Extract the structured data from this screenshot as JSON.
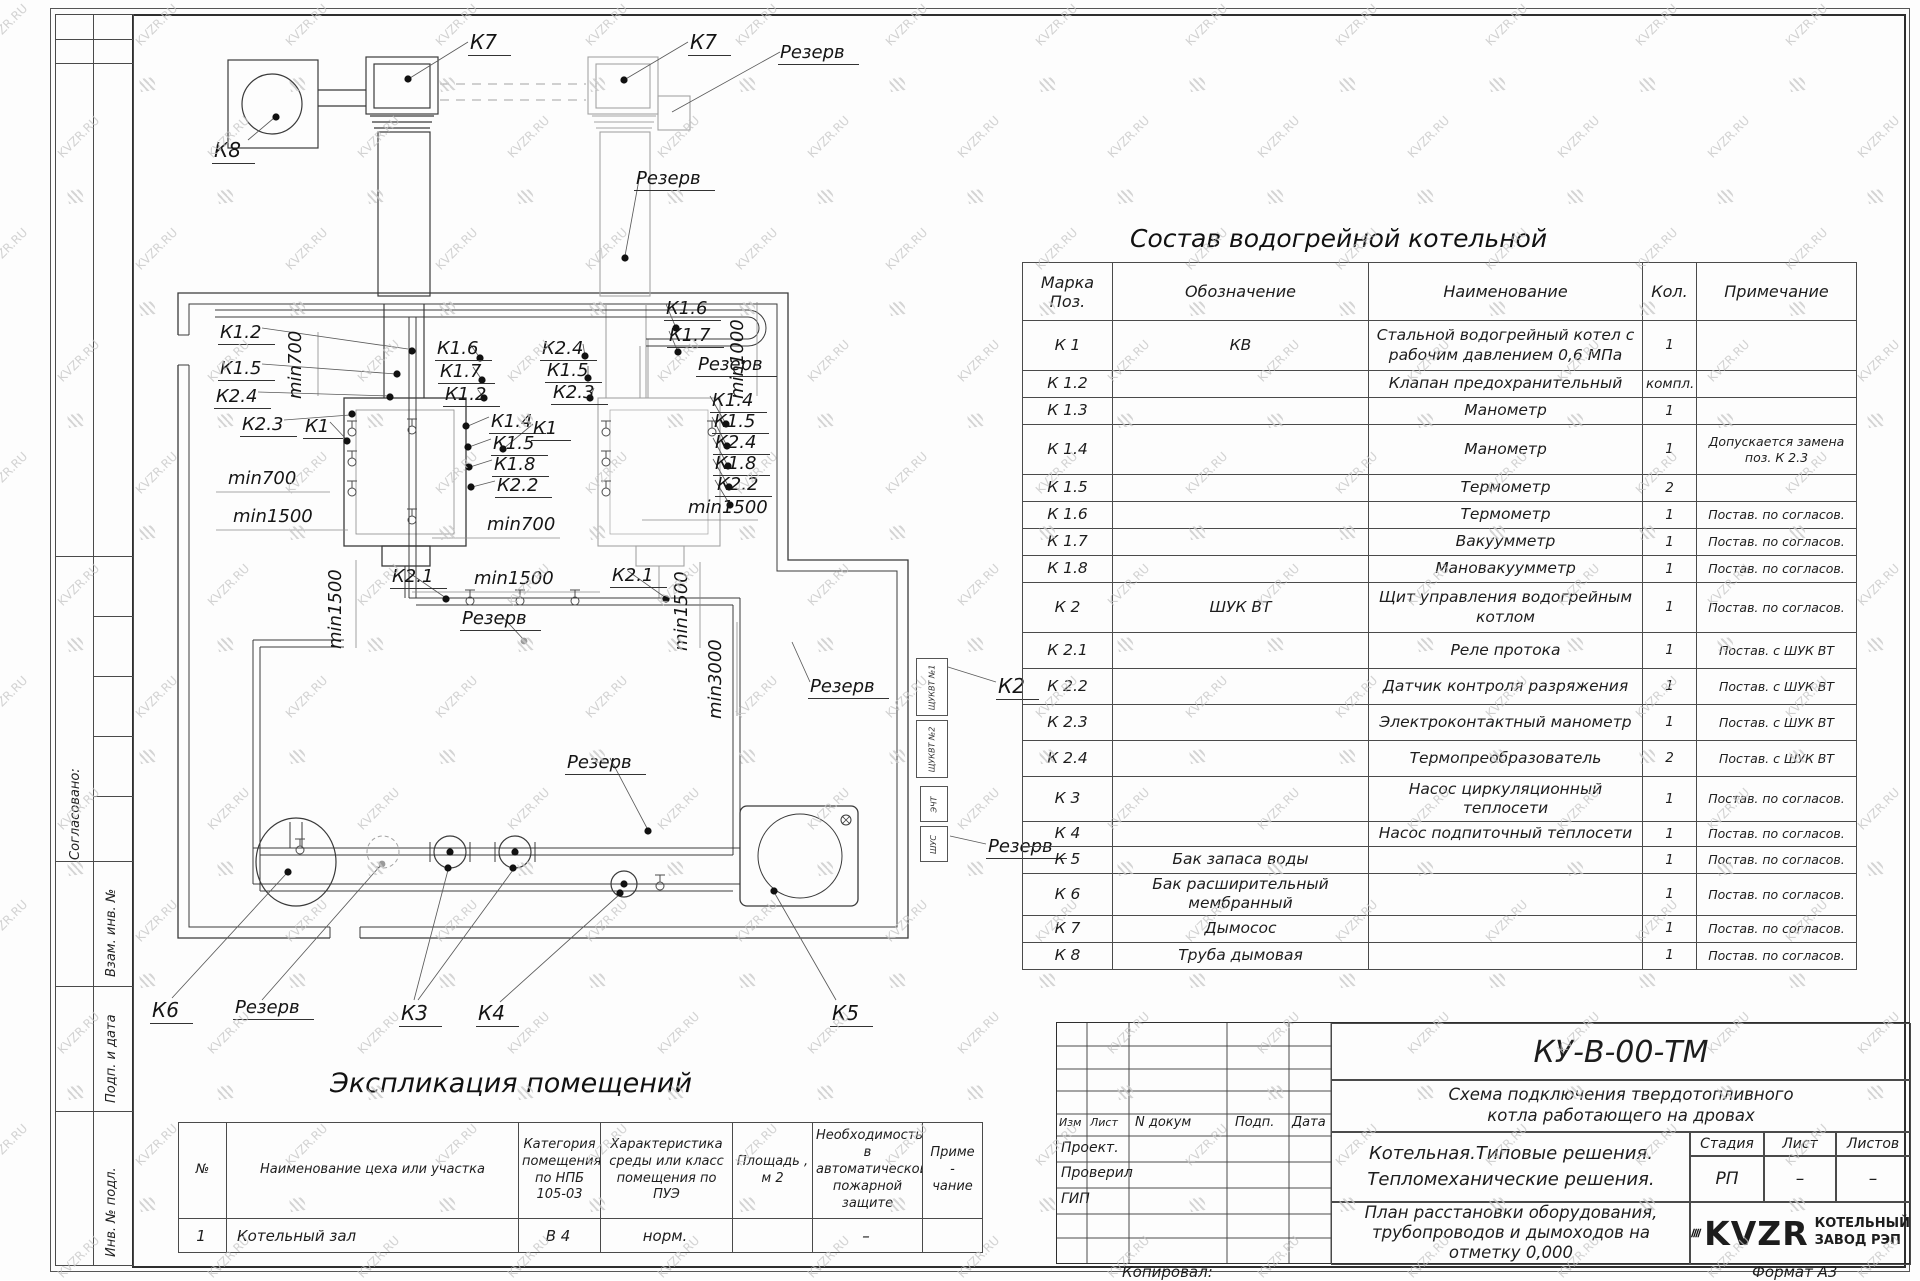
{
  "watermark": {
    "text": "KVZR.RU"
  },
  "frame": {
    "left_stamps": [
      "Согласовано:",
      "Взам. инв. №",
      "Подп. и дата",
      "Инв. № подл."
    ],
    "copied_label": "Копировал:",
    "format_label": "Формат А3"
  },
  "plan": {
    "labels": [
      {
        "t": "К7",
        "x": 468,
        "y": 30,
        "u": 1,
        "big": 1
      },
      {
        "t": "К7",
        "x": 688,
        "y": 30,
        "u": 1,
        "big": 1
      },
      {
        "t": "К8",
        "x": 212,
        "y": 138,
        "u": 1,
        "big": 1
      },
      {
        "t": "Резерв",
        "x": 778,
        "y": 42,
        "u": 1
      },
      {
        "t": "Резерв",
        "x": 634,
        "y": 168,
        "u": 1
      },
      {
        "t": "К1.2",
        "x": 218,
        "y": 322,
        "u": 1
      },
      {
        "t": "К1.5",
        "x": 218,
        "y": 358,
        "u": 1
      },
      {
        "t": "К2.4",
        "x": 214,
        "y": 386,
        "u": 1
      },
      {
        "t": "К2.3",
        "x": 240,
        "y": 414,
        "u": 1
      },
      {
        "t": "К1",
        "x": 303,
        "y": 416,
        "u": 1
      },
      {
        "t": "min700",
        "x": 306,
        "y": 398,
        "v": 1
      },
      {
        "t": "min700",
        "x": 228,
        "y": 468
      },
      {
        "t": "min1500",
        "x": 233,
        "y": 506
      },
      {
        "t": "min1500",
        "x": 346,
        "y": 648,
        "v": 1
      },
      {
        "t": "К1.6",
        "x": 435,
        "y": 338,
        "u": 1
      },
      {
        "t": "К1.7",
        "x": 438,
        "y": 361,
        "u": 1
      },
      {
        "t": "К1.2",
        "x": 443,
        "y": 384,
        "u": 1
      },
      {
        "t": "К2.4",
        "x": 540,
        "y": 338,
        "u": 1
      },
      {
        "t": "К1.5",
        "x": 545,
        "y": 360,
        "u": 1
      },
      {
        "t": "К2.3",
        "x": 551,
        "y": 382,
        "u": 1
      },
      {
        "t": "К1.4",
        "x": 489,
        "y": 411,
        "u": 1
      },
      {
        "t": "К1.5",
        "x": 491,
        "y": 433,
        "u": 1
      },
      {
        "t": "К1.8",
        "x": 492,
        "y": 454,
        "u": 1
      },
      {
        "t": "К2.2",
        "x": 495,
        "y": 475,
        "u": 1
      },
      {
        "t": "К1",
        "x": 531,
        "y": 418,
        "u": 1
      },
      {
        "t": "min700",
        "x": 487,
        "y": 514
      },
      {
        "t": "min1500",
        "x": 474,
        "y": 568
      },
      {
        "t": "К2.1",
        "x": 390,
        "y": 566,
        "u": 1
      },
      {
        "t": "К1.6",
        "x": 664,
        "y": 298,
        "u": 1
      },
      {
        "t": "К1.7",
        "x": 667,
        "y": 325,
        "u": 1
      },
      {
        "t": "Резерв",
        "x": 696,
        "y": 354,
        "u": 1
      },
      {
        "t": "min1000",
        "x": 748,
        "y": 398,
        "v": 1
      },
      {
        "t": "К1.4",
        "x": 710,
        "y": 390,
        "u": 1
      },
      {
        "t": "К1.5",
        "x": 712,
        "y": 411,
        "u": 1
      },
      {
        "t": "К2.4",
        "x": 713,
        "y": 432,
        "u": 1
      },
      {
        "t": "К1.8",
        "x": 713,
        "y": 453,
        "u": 1
      },
      {
        "t": "К2.2",
        "x": 715,
        "y": 474,
        "u": 1
      },
      {
        "t": "min1500",
        "x": 688,
        "y": 497
      },
      {
        "t": "min1500",
        "x": 692,
        "y": 650,
        "v": 1
      },
      {
        "t": "К2.1",
        "x": 610,
        "y": 565,
        "u": 1
      },
      {
        "t": "min3000",
        "x": 726,
        "y": 718,
        "v": 1
      },
      {
        "t": "Резерв",
        "x": 808,
        "y": 676,
        "u": 1
      },
      {
        "t": "К2",
        "x": 996,
        "y": 674,
        "u": 1,
        "big": 1
      },
      {
        "t": "Резерв",
        "x": 986,
        "y": 836,
        "u": 1
      },
      {
        "t": "Резерв",
        "x": 460,
        "y": 608,
        "u": 1
      },
      {
        "t": "Резерв",
        "x": 565,
        "y": 752,
        "u": 1
      },
      {
        "t": "К6",
        "x": 150,
        "y": 998,
        "u": 1,
        "big": 1
      },
      {
        "t": "Резерв",
        "x": 233,
        "y": 997,
        "u": 1
      },
      {
        "t": "К3",
        "x": 399,
        "y": 1001,
        "u": 1,
        "big": 1
      },
      {
        "t": "К4",
        "x": 476,
        "y": 1001,
        "u": 1,
        "big": 1
      },
      {
        "t": "К5",
        "x": 830,
        "y": 1001,
        "u": 1,
        "big": 1
      }
    ],
    "boxes": [
      {
        "t": "ЩУКВТ №1",
        "x": 916,
        "y": 658,
        "w": 30,
        "h": 56
      },
      {
        "t": "ЩУКВТ №2",
        "x": 916,
        "y": 720,
        "w": 30,
        "h": 56
      },
      {
        "t": "ЭЧТ",
        "x": 920,
        "y": 786,
        "w": 26,
        "h": 34
      },
      {
        "t": "ШУС",
        "x": 920,
        "y": 826,
        "w": 26,
        "h": 34
      }
    ]
  },
  "parts_table": {
    "title": "Состав водогрейной котельной",
    "header": {
      "pos": "Марка\nПоз.",
      "des": "Обозначение",
      "name": "Наименование",
      "qty": "Кол.",
      "note": "Примечание"
    },
    "rows": [
      {
        "pos": "К 1",
        "des": "КВ",
        "name": "Стальной водогрейный котел с рабочим давлением 0,6  МПа",
        "qty": "1",
        "note": "",
        "h": 50
      },
      {
        "pos": "К 1.2",
        "des": "",
        "name": "Клапан предохранительный",
        "qty": "компл.",
        "note": "",
        "h": 27
      },
      {
        "pos": "К 1.3",
        "des": "",
        "name": "Манометр",
        "qty": "1",
        "note": "",
        "h": 27
      },
      {
        "pos": "К 1.4",
        "des": "",
        "name": "Манометр",
        "qty": "1",
        "note": "Допускается замена поз. К 2.3",
        "h": 50
      },
      {
        "pos": "К 1.5",
        "des": "",
        "name": "Термометр",
        "qty": "2",
        "note": "",
        "h": 27
      },
      {
        "pos": "К 1.6",
        "des": "",
        "name": "Термометр",
        "qty": "1",
        "note": "Постав. по согласов.",
        "h": 27
      },
      {
        "pos": "К 1.7",
        "des": "",
        "name": "Вакуумметр",
        "qty": "1",
        "note": "Постав. по согласов.",
        "h": 27
      },
      {
        "pos": "К 1.8",
        "des": "",
        "name": "Мановакуумметр",
        "qty": "1",
        "note": "Постав. по согласов.",
        "h": 27
      },
      {
        "pos": "К 2",
        "des": "ШУК ВТ",
        "name": "Щит управления водогрейным котлом",
        "qty": "1",
        "note": "Постав. по согласов.",
        "h": 50
      },
      {
        "pos": "К 2.1",
        "des": "",
        "name": "Реле протока",
        "qty": "1",
        "note": "Постав. с ШУК ВТ",
        "h": 36
      },
      {
        "pos": "К 2.2",
        "des": "",
        "name": "Датчик контроля разряжения",
        "qty": "1",
        "note": "Постав. с ШУК ВТ",
        "h": 36
      },
      {
        "pos": "К 2.3",
        "des": "",
        "name": "Электроконтактный манометр",
        "qty": "1",
        "note": "Постав. с ШУК ВТ",
        "h": 36
      },
      {
        "pos": "К 2.4",
        "des": "",
        "name": "Термопреобразователь",
        "qty": "2",
        "note": "Постав. с ШУК ВТ",
        "h": 36
      },
      {
        "pos": "К 3",
        "des": "",
        "name": "Насос циркуляционный теплосети",
        "qty": "1",
        "note": "Постав. по согласов.",
        "h": 45
      },
      {
        "pos": "К 4",
        "des": "",
        "name": "Насос подпиточный теплосети",
        "qty": "1",
        "note": "Постав. по согласов.",
        "h": 25
      },
      {
        "pos": "К 5",
        "des": "Бак запаса воды",
        "name": "",
        "qty": "1",
        "note": "Постав. по согласов.",
        "h": 27
      },
      {
        "pos": "К 6",
        "des": "Бак расширительный мембранный",
        "name": "",
        "qty": "1",
        "note": "Постав. по согласов.",
        "h": 41
      },
      {
        "pos": "К 7",
        "des": "Дымосос",
        "name": "",
        "qty": "1",
        "note": "Постав. по согласов.",
        "h": 27
      },
      {
        "pos": "К 8",
        "des": "Труба дымовая",
        "name": "",
        "qty": "1",
        "note": "Постав. по согласов.",
        "h": 27
      }
    ]
  },
  "rooms_table": {
    "title": "Экспликация помещений",
    "headers": [
      "№",
      "Наименование цеха или участка",
      "Категория\nпомещения\nпо НПБ\n105-03",
      "Характеристика\nсреды или класс\nпомещения по\nПУЭ",
      "Площадь ,\nм 2",
      "Необходимость в\nавтоматической\nпожарной защите",
      "Приме -\nчание"
    ],
    "rows": [
      [
        "1",
        "Котельный зал",
        "В 4",
        "норм.",
        "",
        "–",
        ""
      ]
    ]
  },
  "title_block": {
    "doc_number": "КУ-В-00-ТМ",
    "doc_title_1": "Схема подключения твердотопливного",
    "doc_title_2": "котла работающего на дровах",
    "rev_cols": [
      "Изм",
      "Лист",
      "N докум",
      "Подп.",
      "Дата"
    ],
    "roles": [
      "Проект.",
      "Проверил",
      "ГИП"
    ],
    "project_1": "Котельная.Типовые решения.",
    "project_2": "Тепломеханические решения.",
    "sheet_title_1": "План расстановки оборудования,",
    "sheet_title_2": "трубопроводов и дымоходов на",
    "sheet_title_3": "отметку 0,000",
    "stage_label": "Стадия",
    "sheet_label": "Лист",
    "sheets_label": "Листов",
    "stage": "РП",
    "sheet": "–",
    "sheets": "–",
    "logo_text": "KVZR",
    "company_1": "КОТЕЛЬНЫЙ",
    "company_2": "ЗАВОД РЭП"
  }
}
